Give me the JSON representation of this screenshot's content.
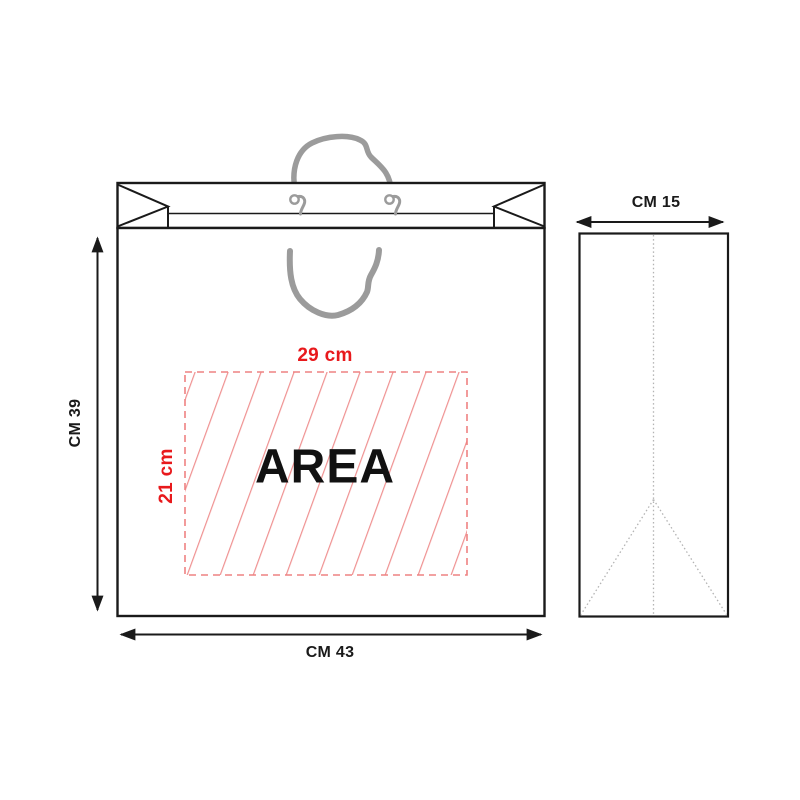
{
  "front_view": {
    "width_label": "CM 43",
    "height_label": "CM 39",
    "print_area": {
      "label": "AREA",
      "width_label": "29 cm",
      "height_label": "21 cm"
    }
  },
  "side_view": {
    "width_label": "CM 15"
  },
  "colors": {
    "outline": "#1a1a1a",
    "rope_gray": "#9b9b9b",
    "accent_red": "#e8191c",
    "hatch_red": "#ef9191",
    "hatch_border": "#ee8282",
    "dotted_gray": "#b3b3b3"
  }
}
